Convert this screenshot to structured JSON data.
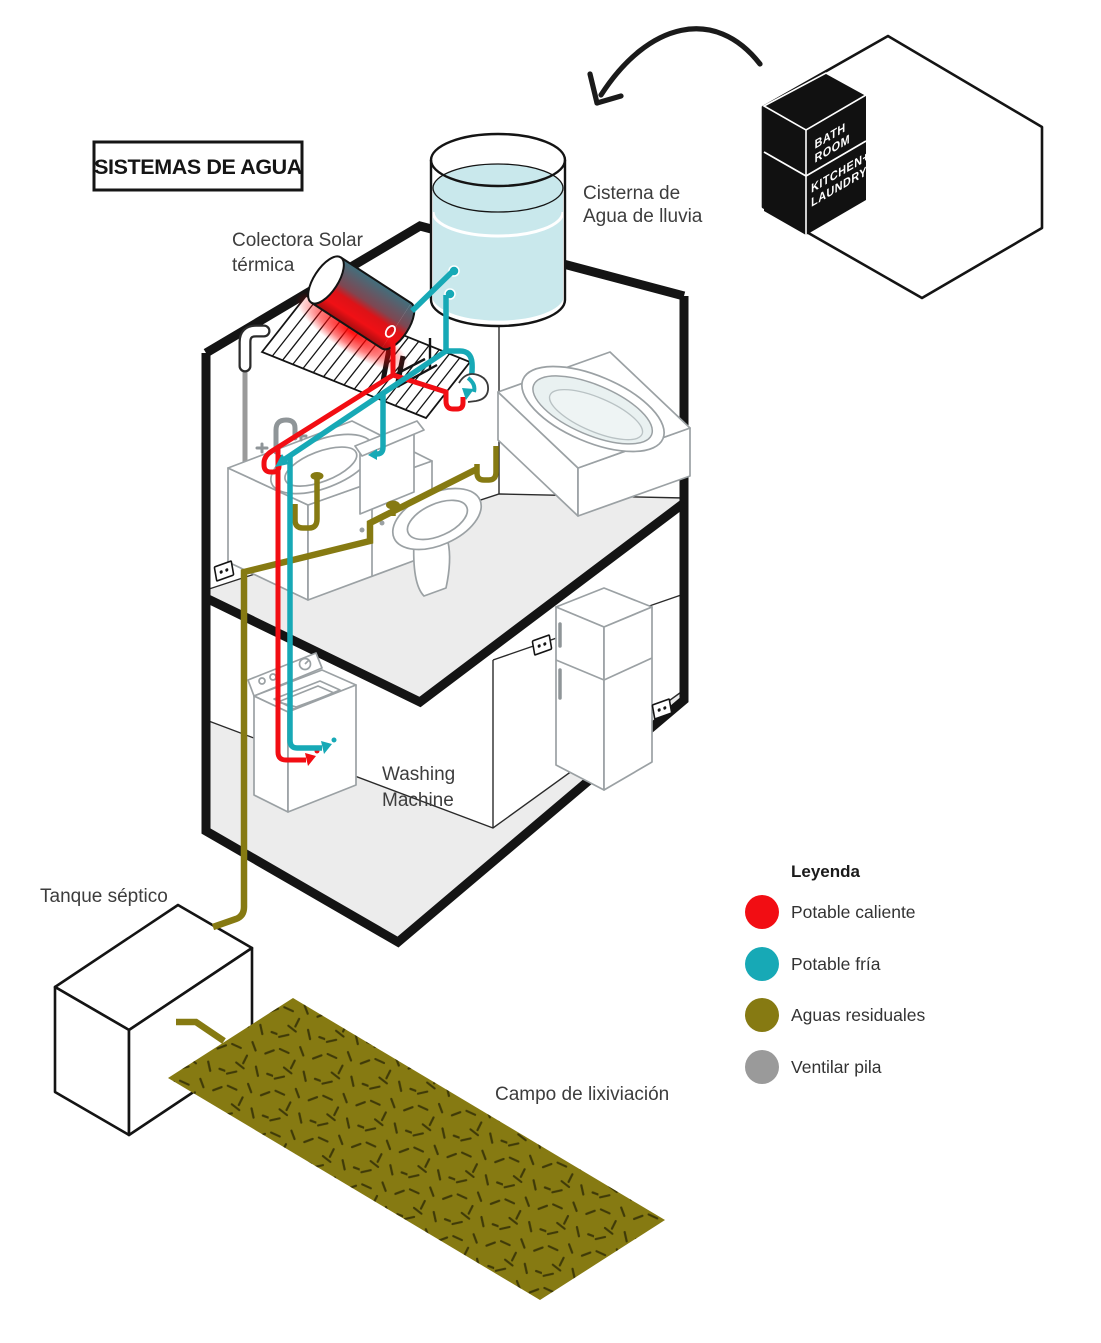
{
  "title": {
    "text": "SISTEMAS DE AGUA"
  },
  "colors": {
    "hot": "#f20d13",
    "cold": "#17a9b6",
    "waste": "#867a12",
    "vent": "#9a9a9a",
    "water": "#c9e8ec",
    "floor": "#ececec",
    "ink": "#141414"
  },
  "labels": {
    "solar": {
      "line1": "Colectora Solar",
      "line2": "térmica"
    },
    "cistern": {
      "line1": "Cisterna de",
      "line2": "Agua de lluvia"
    },
    "washing": {
      "line1": "Washing",
      "line2": "Machine"
    },
    "septic": {
      "text": "Tanque séptico"
    },
    "leach": {
      "text": "Campo de lixiviación"
    }
  },
  "room_cube": {
    "top_line1": "BATH",
    "top_line2": "ROOM",
    "bottom_line1": "KITCHEN+",
    "bottom_line2": "LAUNDRY"
  },
  "legend": {
    "heading": "Leyenda",
    "items": [
      {
        "label": "Potable caliente",
        "color": "#f20d13"
      },
      {
        "label": "Potable fría",
        "color": "#17a9b6"
      },
      {
        "label": "Aguas residuales",
        "color": "#867a12"
      },
      {
        "label": "Ventilar pila",
        "color": "#9a9a9a"
      }
    ]
  }
}
